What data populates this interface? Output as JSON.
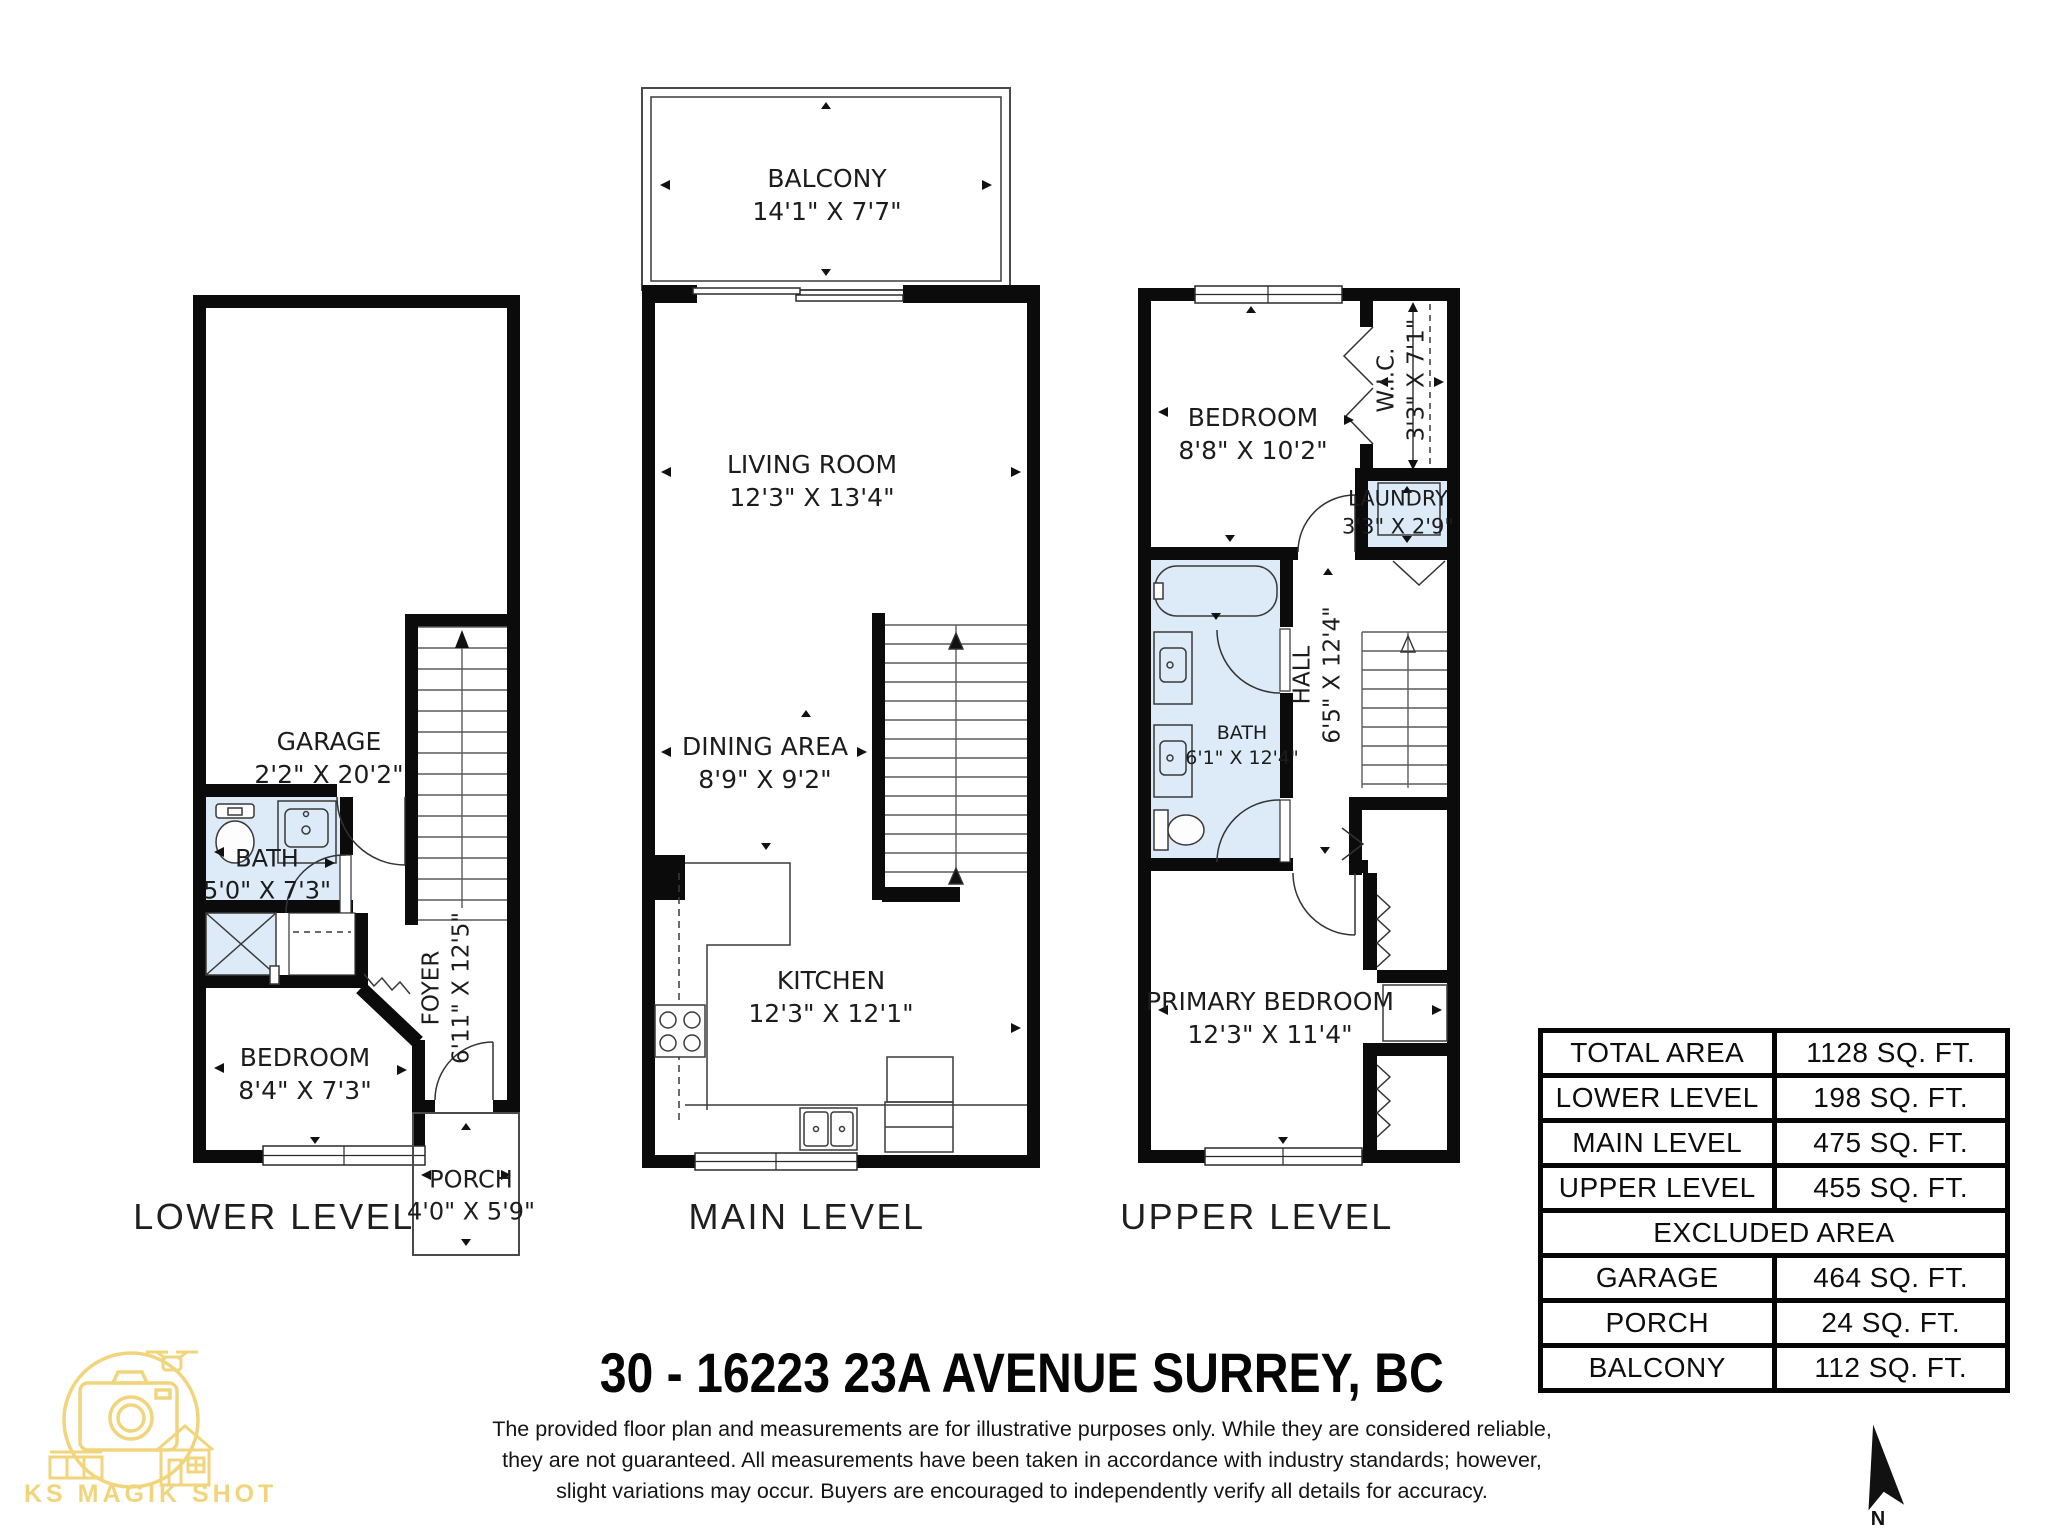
{
  "meta": {
    "address": "30 - 16223 23A AVENUE SURREY, BC",
    "brand": "KS MAGIK SHOT",
    "north_label": "N"
  },
  "disclaimer": {
    "line1": "The provided floor plan and measurements are for illustrative purposes only. While they are considered reliable,",
    "line2": "they are not guaranteed. All measurements have been taken in accordance with industry standards; however,",
    "line3": "slight variations may occur. Buyers are encouraged to independently verify all details for accuracy."
  },
  "levels": {
    "lower": {
      "caption": "LOWER LEVEL",
      "rooms": {
        "garage": {
          "name": "GARAGE",
          "dims": "2'2\" X 20'2\""
        },
        "bath": {
          "name": "BATH",
          "dims": "5'0\" X 7'3\""
        },
        "bedroom": {
          "name": "BEDROOM",
          "dims": "8'4\" X 7'3\""
        },
        "foyer": {
          "name": "FOYER",
          "dims": "6'11\" X 12'5\""
        },
        "porch": {
          "name": "PORCH",
          "dims": "4'0\" X 5'9\""
        }
      }
    },
    "main": {
      "caption": "MAIN LEVEL",
      "rooms": {
        "balcony": {
          "name": "BALCONY",
          "dims": "14'1\" X 7'7\""
        },
        "living": {
          "name": "LIVING ROOM",
          "dims": "12'3\" X 13'4\""
        },
        "dining": {
          "name": "DINING AREA",
          "dims": "8'9\" X 9'2\""
        },
        "kitchen": {
          "name": "KITCHEN",
          "dims": "12'3\" X 12'1\""
        }
      }
    },
    "upper": {
      "caption": "UPPER LEVEL",
      "rooms": {
        "bedroom": {
          "name": "BEDROOM",
          "dims": "8'8\" X 10'2\""
        },
        "wic": {
          "name": "W.I.C.",
          "dims": "3'3\" X 7'1\""
        },
        "laundry": {
          "name": "LAUNDRY",
          "dims": "3'3\" X 2'9\""
        },
        "bath": {
          "name": "BATH",
          "dims": "6'1\" X 12'4\""
        },
        "hall": {
          "name": "HALL",
          "dims": "6'5\" X 12'4\""
        },
        "primary": {
          "name": "PRIMARY BEDROOM",
          "dims": "12'3\" X 11'4\""
        }
      }
    }
  },
  "area_table": {
    "rows": [
      {
        "label": "TOTAL AREA",
        "value": "1128 SQ. FT."
      },
      {
        "label": "LOWER LEVEL",
        "value": "198 SQ. FT."
      },
      {
        "label": "MAIN LEVEL",
        "value": "475 SQ. FT."
      },
      {
        "label": "UPPER LEVEL",
        "value": "455 SQ. FT."
      }
    ],
    "excluded_header": "EXCLUDED AREA",
    "excluded_rows": [
      {
        "label": "GARAGE",
        "value": "464 SQ. FT."
      },
      {
        "label": "PORCH",
        "value": "24 SQ. FT."
      },
      {
        "label": "BALCONY",
        "value": "112 SQ. FT."
      }
    ]
  },
  "colors": {
    "wall": "#0b0b0b",
    "wet_room_fill": "#dcebf7",
    "logo_gold": "#f1d57c"
  }
}
